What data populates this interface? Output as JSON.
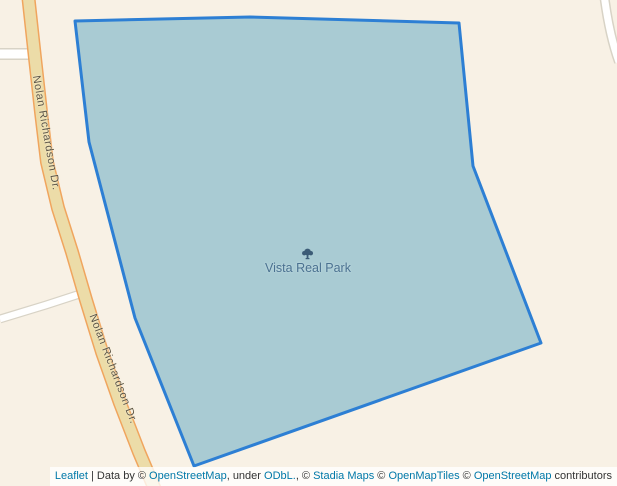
{
  "map": {
    "park": {
      "name": "Vista Real Park"
    },
    "road": {
      "label": "Nolan Richardson Dr."
    }
  },
  "colors": {
    "background": "#f8f1e5",
    "park_fill": "#a6c9d2",
    "park_stroke": "#2d7fd4",
    "road_fill": "#ecdca8",
    "road_casing": "#f0a55e",
    "minor_road_fill": "#ffffff",
    "minor_road_casing": "#d8d3c6",
    "road_label_color": "#5a5344",
    "park_label_color": "#4a7190",
    "tree_icon_color": "#3c5c77",
    "link_color": "#0078a8",
    "attribution_text_color": "#333333"
  },
  "attribution": {
    "segments": [
      {
        "text": "Leaflet",
        "link": true
      },
      {
        "text": " | Data by © ",
        "link": false
      },
      {
        "text": "OpenStreetMap",
        "link": true
      },
      {
        "text": ", under ",
        "link": false
      },
      {
        "text": "ODbL.",
        "link": true
      },
      {
        "text": ", © ",
        "link": false
      },
      {
        "text": "Stadia Maps",
        "link": true
      },
      {
        "text": " © ",
        "link": false
      },
      {
        "text": "OpenMapTiles",
        "link": true
      },
      {
        "text": " © ",
        "link": false
      },
      {
        "text": "OpenStreetMap",
        "link": true
      },
      {
        "text": " contributors",
        "link": false
      }
    ]
  }
}
